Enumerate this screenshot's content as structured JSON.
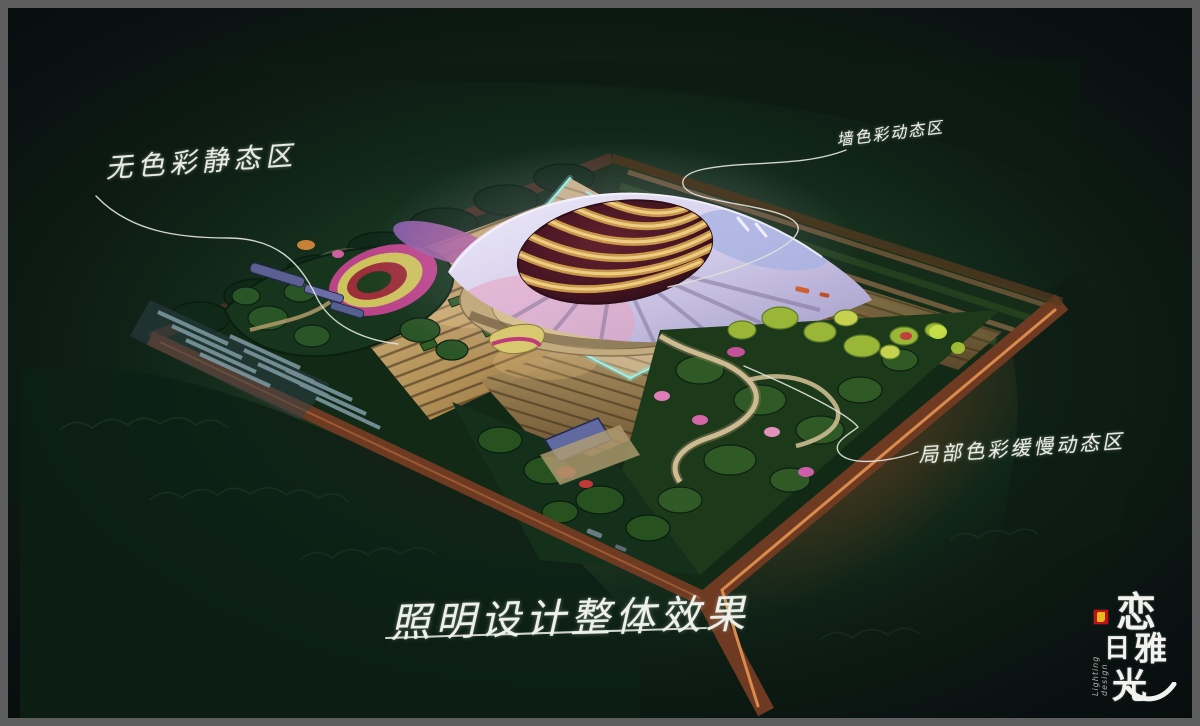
{
  "artwork": {
    "type": "architectural-lighting-design-night-rendering",
    "annotations": {
      "left": "无色彩静态区",
      "top_right": "墙色彩动态区",
      "right": "局部色彩缓慢动态区"
    },
    "title": "照明设计整体效果",
    "logo": {
      "chars": [
        "恋",
        "日",
        "雅",
        "光"
      ],
      "subtitle": "Lighting design",
      "seal_color": "#bf1217",
      "seal_mark_color": "#e9b71e"
    },
    "colors": {
      "frame_gray": "#5e5e5e",
      "night_background": "#0c1413",
      "site_green": "#17331d",
      "road_rust": "#6e3b22",
      "road_centerline": "#d98a4c",
      "plaza_beige": "#c9ab74",
      "platform_edge_cyan": "#9df2ea",
      "roof_lavender": "#d6d0ec",
      "roof_pink": "#e8b9cd",
      "dome_maroon": "#4a1823",
      "dome_gold": "#d4a050",
      "flower_magenta": "#bb4489",
      "flower_purple": "#8a5fb0",
      "flower_yellow": "#cdc35c",
      "foliage_bright": "#9ab636",
      "annotation_ink": "#e8ebe3"
    }
  }
}
